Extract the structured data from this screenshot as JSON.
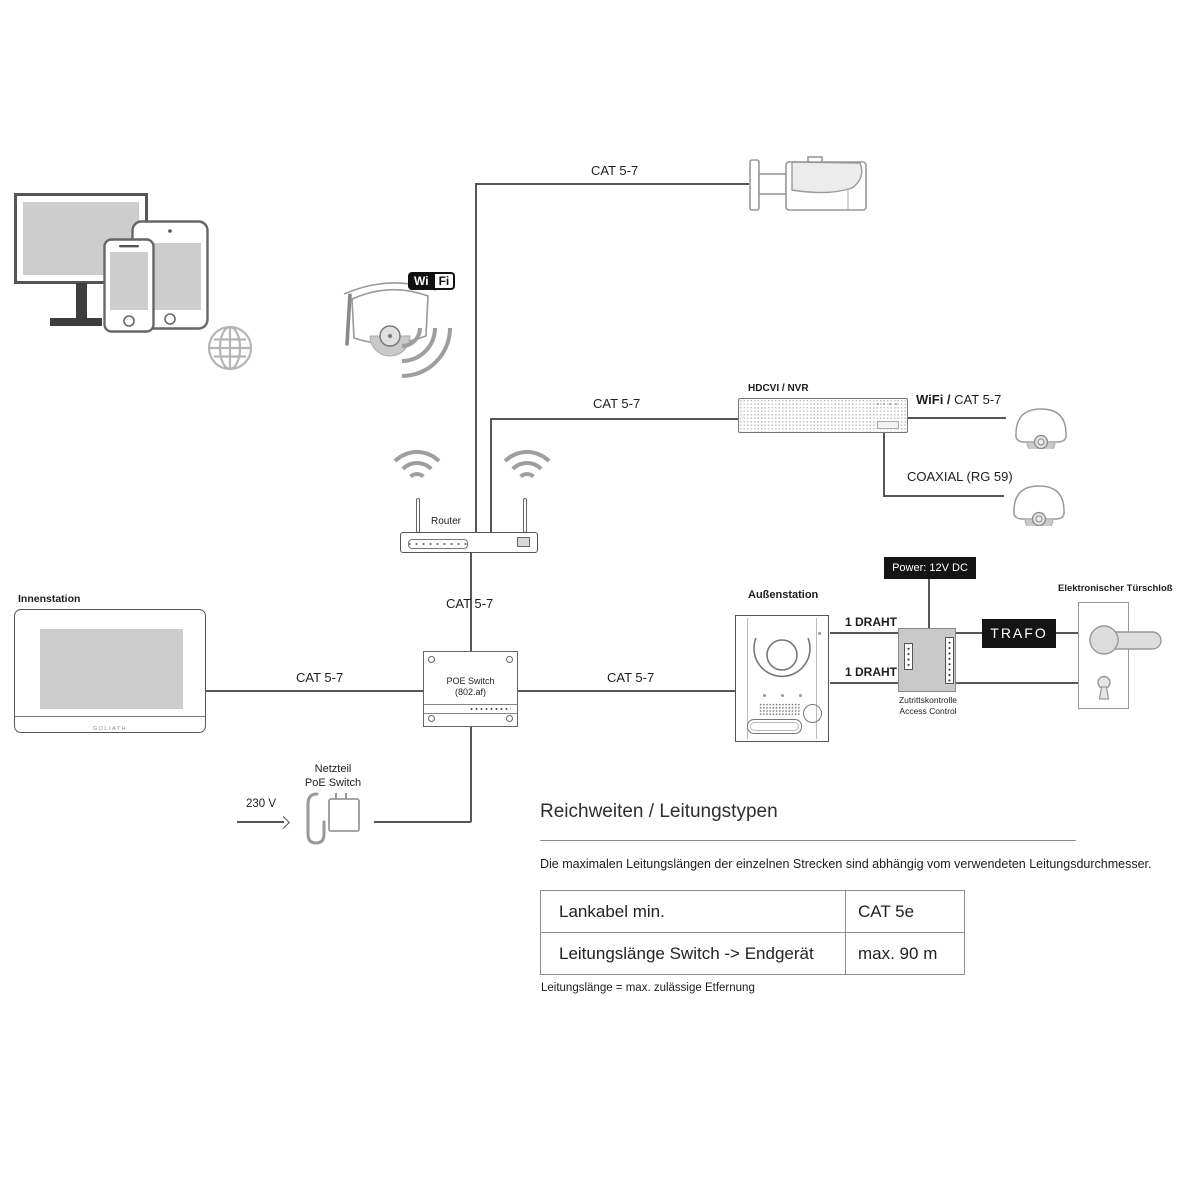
{
  "labels": {
    "innenstation": "Innenstation",
    "aussenstation": "Außenstation",
    "router": "Router",
    "hdcvi_nvr": "HDCVI / NVR",
    "wifi_badge_wi": "Wi",
    "wifi_badge_fi": "Fi",
    "cat57_top": "CAT 5-7",
    "cat57_router_nvr": "CAT 5-7",
    "cat57_router_switch": "CAT 5-7",
    "cat57_innen_switch": "CAT 5-7",
    "cat57_switch_aussen": "CAT 5-7",
    "wifi_prefix": "WiFi /",
    "wifi_cat": "CAT 5-7",
    "coaxial": "COAXIAL (RG 59)",
    "power": "Power: 12V DC",
    "draht_top": "1 DRAHT",
    "draht_bottom": "1 DRAHT",
    "trafo": "TRAFO",
    "access_de": "Zutrittskontrolle",
    "access_en": "Access Control",
    "door_lock": "Elektronischer Türschloß",
    "poe_switch": "POE Switch",
    "poe_standard": "(802.af)",
    "netzteil_1": "Netzteil",
    "netzteil_2": "PoE Switch",
    "voltage": "230 V",
    "brand": "GOLIATH"
  },
  "info": {
    "heading": "Reichweiten / Leitungstypen",
    "description": "Die maximalen Leitungslängen der einzelnen Strecken sind abhängig vom verwendeten Leitungsdurchmesser.",
    "table": {
      "rows": [
        {
          "label": "Lankabel min.",
          "value": "CAT 5e"
        },
        {
          "label": "Leitungslänge Switch -> Endgerät",
          "value": "max. 90 m"
        }
      ]
    },
    "footnote": "Leitungslänge = max. zulässige Etfernung"
  },
  "colors": {
    "line": "#565656",
    "black_box": "#141414",
    "gray_box": "#c9c9c9",
    "screen_fill": "#cdcdcd"
  }
}
